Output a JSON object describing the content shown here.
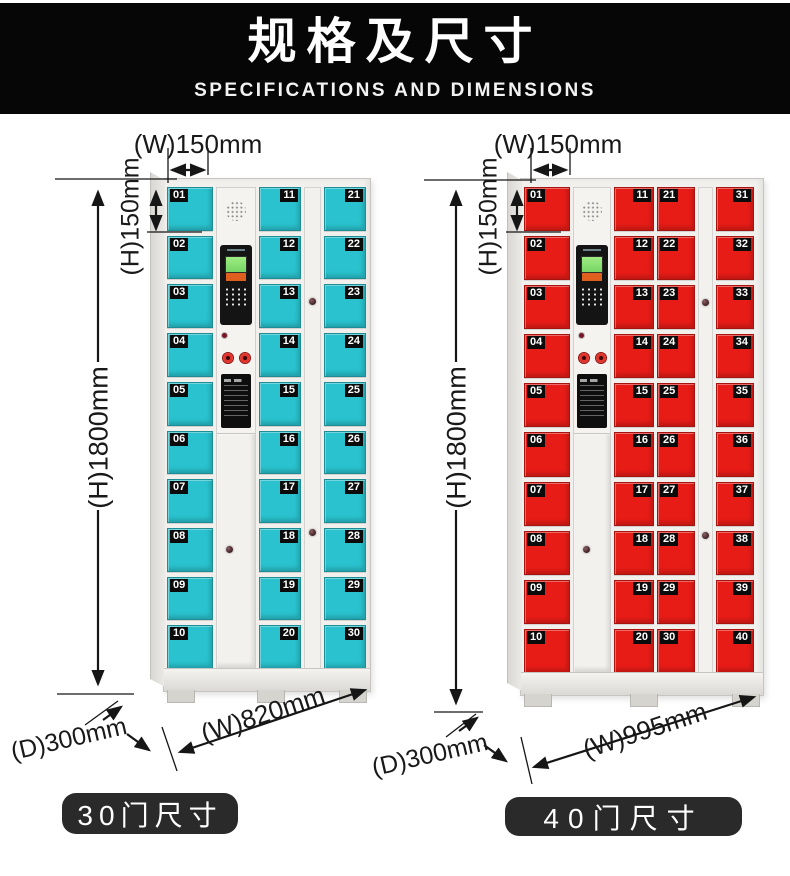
{
  "header": {
    "title": "规格及尺寸",
    "subtitle": "SPECIFICATIONS AND DIMENSIONS"
  },
  "lockers": [
    {
      "name": "30-door locker",
      "door_color": "#29c2ce",
      "door_count": 30,
      "button_label": "30门尺寸",
      "dimensions": {
        "cell_width": "(W)150mm",
        "cell_height": "(H)150mm",
        "height": "(H)1800mm",
        "depth": "(D)300mm",
        "width": "(W)820mm"
      },
      "columns": [
        {
          "type": "doors",
          "badge_side": "left",
          "numbers": [
            "01",
            "02",
            "03",
            "04",
            "05",
            "06",
            "07",
            "08",
            "09",
            "10"
          ]
        },
        {
          "type": "control"
        },
        {
          "type": "doors",
          "badge_side": "right",
          "numbers": [
            "11",
            "12",
            "13",
            "14",
            "15",
            "16",
            "17",
            "18",
            "19",
            "20"
          ]
        },
        {
          "type": "strip"
        },
        {
          "type": "doors",
          "badge_side": "right",
          "numbers": [
            "21",
            "22",
            "23",
            "24",
            "25",
            "26",
            "27",
            "28",
            "29",
            "30"
          ]
        }
      ]
    },
    {
      "name": "40-door locker",
      "door_color": "#e71c17",
      "door_count": 40,
      "button_label": "40门尺寸",
      "dimensions": {
        "cell_width": "(W)150mm",
        "cell_height": "(H)150mm",
        "height": "(H)1800mm",
        "depth": "(D)300mm",
        "width": "(W)995mm"
      },
      "columns": [
        {
          "type": "doors",
          "badge_side": "left",
          "numbers": [
            "01",
            "02",
            "03",
            "04",
            "05",
            "06",
            "07",
            "08",
            "09",
            "10"
          ]
        },
        {
          "type": "control"
        },
        {
          "type": "doors",
          "badge_side": "right",
          "numbers": [
            "11",
            "12",
            "13",
            "14",
            "15",
            "16",
            "17",
            "18",
            "19",
            "20"
          ]
        },
        {
          "type": "doors",
          "badge_side": "left",
          "numbers": [
            "21",
            "22",
            "23",
            "24",
            "25",
            "26",
            "27",
            "28",
            "29",
            "30"
          ]
        },
        {
          "type": "strip"
        },
        {
          "type": "doors",
          "badge_side": "right",
          "numbers": [
            "31",
            "32",
            "33",
            "34",
            "35",
            "36",
            "37",
            "38",
            "39",
            "40"
          ]
        }
      ]
    }
  ]
}
